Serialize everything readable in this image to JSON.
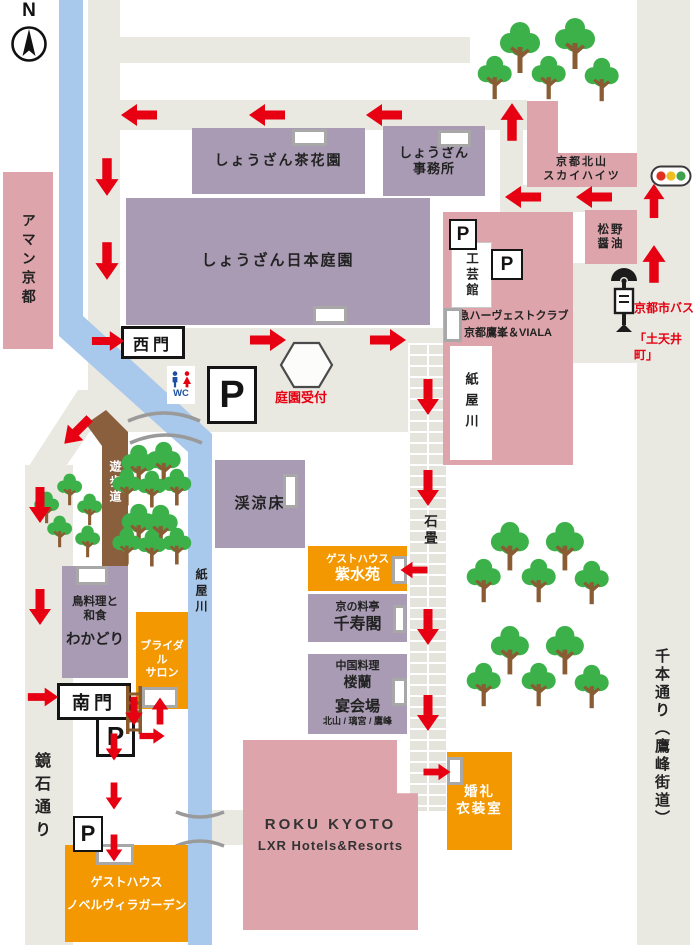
{
  "compass": {
    "label": "N"
  },
  "gates": {
    "west": "西門",
    "south": "南門"
  },
  "markers": {
    "parking": "P",
    "wc": "WC",
    "garden_reception": "庭園受付",
    "stone_pavement": "石畳",
    "promenade": "遊歩道",
    "river_label": "紙屋川",
    "river_box_label": "紙屋川"
  },
  "streets": {
    "kagamiishi": "鏡石通り",
    "senbon": "千本通り（鷹峰街道）"
  },
  "bus_stop": {
    "line1": "京都市バス",
    "line2": "「土天井町」"
  },
  "buildings": {
    "chakaen": {
      "name": "しょうざん茶花園"
    },
    "office": {
      "name": "しょうざん\n事務所"
    },
    "nihon_teien": {
      "name": "しょうざん日本庭園"
    },
    "keiryosho": {
      "name": "渓涼床"
    },
    "wakadori": {
      "type": "鳥料理と\n和食",
      "name": "わかどり"
    },
    "sky_heights": {
      "name": "京都北山\nスカイハイツ"
    },
    "matsuno": {
      "name": "松野\n醤油"
    },
    "kogeikan": {
      "name": "工芸館"
    },
    "tokyu": {
      "name": "東急ハーヴェストクラブ\n京都鷹峯＆VIALA"
    },
    "aman": {
      "name": "アマン京都"
    },
    "shisuien": {
      "type": "ゲストハウス",
      "name": "紫水苑"
    },
    "senjukaku": {
      "type": "京の料亭",
      "name": "千寿閣"
    },
    "rouran": {
      "type": "中国料理",
      "name": "楼蘭"
    },
    "banquet": {
      "name": "宴会場",
      "rooms": "北山 / 璃宮 / 鷹峰"
    },
    "bridal_salon": {
      "name": "ブライダル\nサロン"
    },
    "wedding_dress": {
      "name": "婚礼\n衣装室"
    },
    "novel_villa": {
      "type": "ゲストハウス",
      "name": "ノベルヴィラガーデン"
    },
    "roku": {
      "name": "ROKU KYOTO",
      "sub": "LXR Hotels&Resorts"
    }
  },
  "colors": {
    "building_purple": "#a89bb3",
    "building_pink": "#dda4ab",
    "building_orange": "#f39800",
    "road_gray": "#e9e8e1",
    "river_blue": "#a9c9ec",
    "arrow_red": "#e60012",
    "tree_green": "#3cb14a",
    "trunk_brown": "#8a5c33",
    "promenade_brown": "#8a5f3e",
    "signal_red": "#e03020",
    "signal_yellow": "#eebf20",
    "signal_green": "#3fa34d"
  },
  "symbols": {
    "arrows": [
      {
        "x": 139,
        "y": 115,
        "d": "left",
        "s": 1
      },
      {
        "x": 267,
        "y": 115,
        "d": "left",
        "s": 1
      },
      {
        "x": 384,
        "y": 115,
        "d": "left",
        "s": 1
      },
      {
        "x": 512,
        "y": 122,
        "d": "up",
        "s": 1.05
      },
      {
        "x": 107,
        "y": 177,
        "d": "down",
        "s": 1.05
      },
      {
        "x": 107,
        "y": 261,
        "d": "down",
        "s": 1.05
      },
      {
        "x": 523,
        "y": 197,
        "d": "left",
        "s": 1
      },
      {
        "x": 594,
        "y": 197,
        "d": "left",
        "s": 1
      },
      {
        "x": 654,
        "y": 201,
        "d": "up",
        "s": 0.95
      },
      {
        "x": 654,
        "y": 264,
        "d": "up",
        "s": 1.05
      },
      {
        "x": 108,
        "y": 341,
        "d": "right",
        "s": 0.9
      },
      {
        "x": 268,
        "y": 340,
        "d": "right",
        "s": 1
      },
      {
        "x": 388,
        "y": 340,
        "d": "right",
        "s": 1
      },
      {
        "x": 428,
        "y": 397,
        "d": "down",
        "s": 1
      },
      {
        "x": 428,
        "y": 488,
        "d": "down",
        "s": 1
      },
      {
        "x": 77,
        "y": 431,
        "d": "downleft",
        "s": 1
      },
      {
        "x": 40,
        "y": 505,
        "d": "down",
        "s": 1
      },
      {
        "x": 40,
        "y": 607,
        "d": "down",
        "s": 1
      },
      {
        "x": 414,
        "y": 570,
        "d": "left",
        "s": 0.75
      },
      {
        "x": 428,
        "y": 627,
        "d": "down",
        "s": 1
      },
      {
        "x": 43,
        "y": 697,
        "d": "right",
        "s": 0.85
      },
      {
        "x": 134,
        "y": 711,
        "d": "down",
        "s": 0.8
      },
      {
        "x": 160,
        "y": 711,
        "d": "up",
        "s": 0.75
      },
      {
        "x": 152,
        "y": 736,
        "d": "right",
        "s": 0.7
      },
      {
        "x": 114,
        "y": 747,
        "d": "down",
        "s": 0.75
      },
      {
        "x": 114,
        "y": 796,
        "d": "down",
        "s": 0.75
      },
      {
        "x": 114,
        "y": 848,
        "d": "down",
        "s": 0.75
      },
      {
        "x": 428,
        "y": 713,
        "d": "down",
        "s": 1
      },
      {
        "x": 437,
        "y": 772,
        "d": "right",
        "s": 0.75
      }
    ],
    "trees": [
      {
        "x": 520,
        "y": 48,
        "s": 1
      },
      {
        "x": 575,
        "y": 44,
        "s": 1
      },
      {
        "x": 495,
        "y": 78,
        "s": 0.85
      },
      {
        "x": 549,
        "y": 78,
        "s": 0.85
      },
      {
        "x": 602,
        "y": 80,
        "s": 0.85
      },
      {
        "x": 139,
        "y": 467,
        "s": 0.85
      },
      {
        "x": 164,
        "y": 464,
        "s": 0.85
      },
      {
        "x": 127,
        "y": 487,
        "s": 0.72
      },
      {
        "x": 152,
        "y": 489,
        "s": 0.72
      },
      {
        "x": 177,
        "y": 487,
        "s": 0.72
      },
      {
        "x": 139,
        "y": 526,
        "s": 0.85
      },
      {
        "x": 161,
        "y": 527,
        "s": 0.85
      },
      {
        "x": 127,
        "y": 546,
        "s": 0.72
      },
      {
        "x": 152,
        "y": 548,
        "s": 0.72
      },
      {
        "x": 177,
        "y": 546,
        "s": 0.72
      },
      {
        "x": 70,
        "y": 490,
        "s": 0.62
      },
      {
        "x": 47,
        "y": 508,
        "s": 0.62
      },
      {
        "x": 90,
        "y": 510,
        "s": 0.62
      },
      {
        "x": 60,
        "y": 532,
        "s": 0.62
      },
      {
        "x": 88,
        "y": 542,
        "s": 0.62
      },
      {
        "x": 510,
        "y": 547,
        "s": 0.95
      },
      {
        "x": 565,
        "y": 547,
        "s": 0.95
      },
      {
        "x": 484,
        "y": 581,
        "s": 0.85
      },
      {
        "x": 539,
        "y": 581,
        "s": 0.85
      },
      {
        "x": 592,
        "y": 583,
        "s": 0.85
      },
      {
        "x": 510,
        "y": 651,
        "s": 0.95
      },
      {
        "x": 565,
        "y": 651,
        "s": 0.95
      },
      {
        "x": 484,
        "y": 685,
        "s": 0.85
      },
      {
        "x": 539,
        "y": 685,
        "s": 0.85
      },
      {
        "x": 592,
        "y": 687,
        "s": 0.85
      }
    ]
  }
}
